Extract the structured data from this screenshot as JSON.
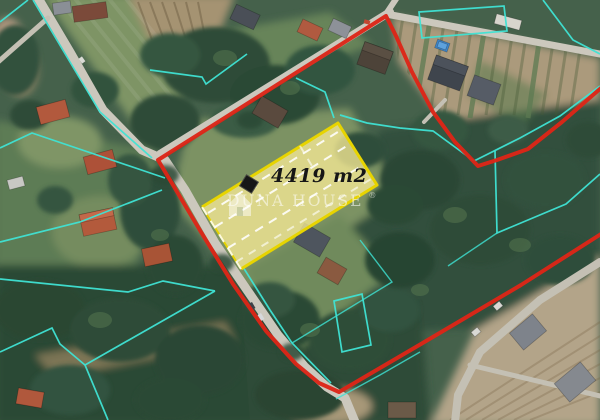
{
  "parcel": {
    "area_label": "4419 m2",
    "fill_color": "#f2e794",
    "border_color": "#e7d400"
  },
  "watermark": {
    "brand": "DUNA HOUSE",
    "registered_mark": "®"
  },
  "overlay_colors": {
    "boundary_red": "#dd2517",
    "cadastral_cyan": "#3fe3d4",
    "marker_black": "#161616",
    "dash_white": "#ffffff"
  }
}
